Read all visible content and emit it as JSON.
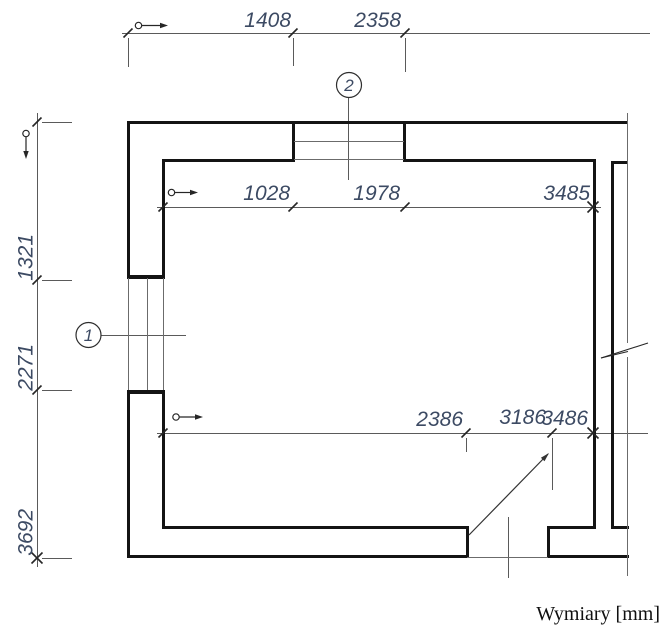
{
  "drawing": {
    "caption": "Wymiary [mm]",
    "dim_text_color": "#3c4a63",
    "wall_color": "#141414",
    "top_outer_dims": [
      "1408",
      "2358"
    ],
    "top_inner_dims": [
      "1028",
      "1978",
      "3485"
    ],
    "bottom_inner_dims": [
      "2386",
      "3186",
      "3486"
    ],
    "left_outer_dims": [
      "1321",
      "2271",
      "3692"
    ],
    "opening_labels": [
      "1",
      "2"
    ]
  }
}
